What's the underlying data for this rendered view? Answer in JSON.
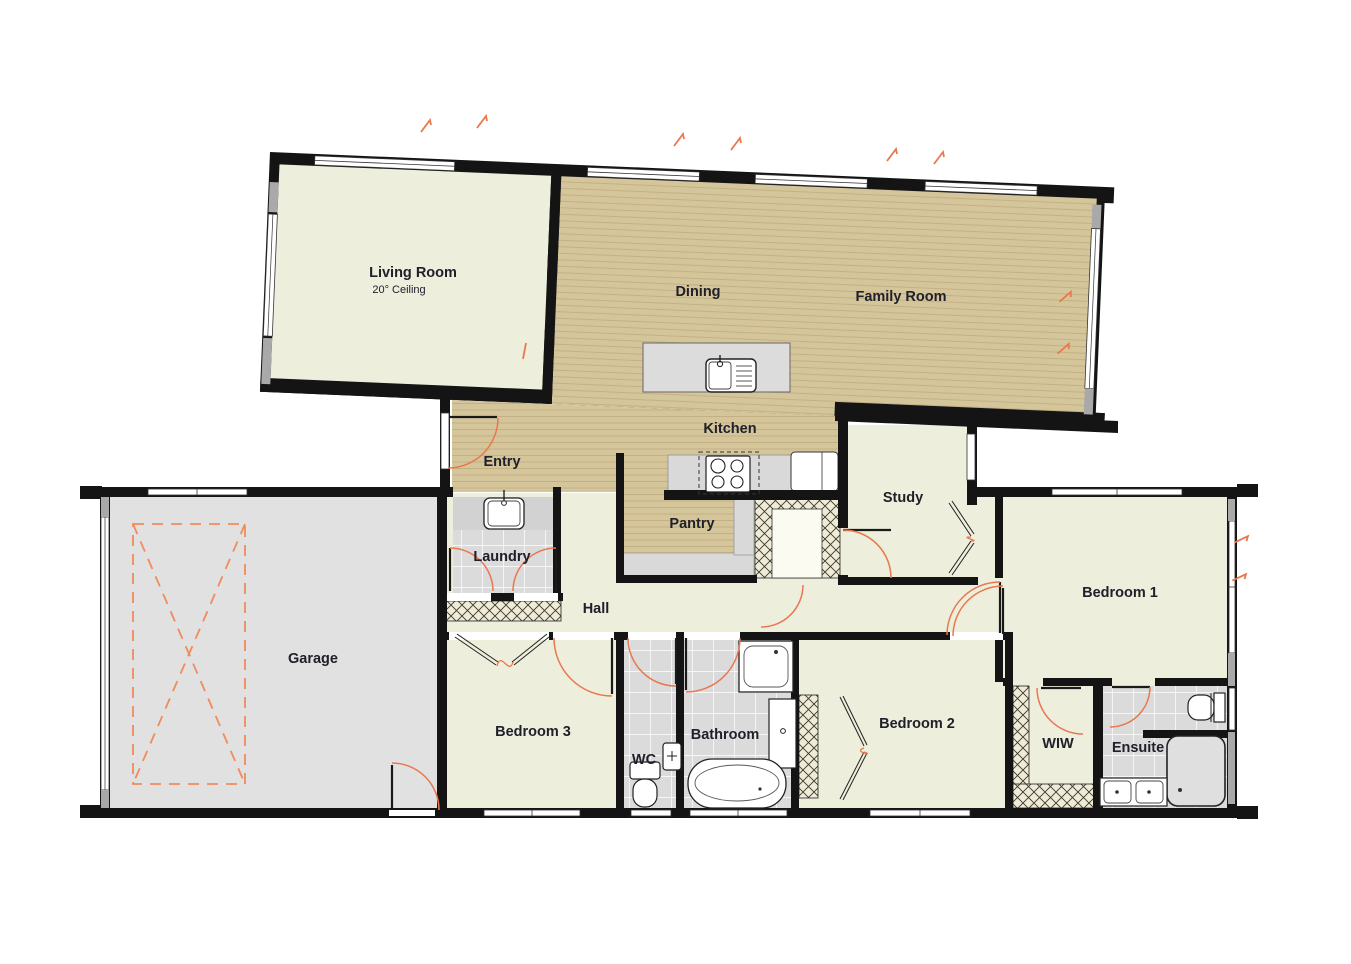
{
  "document": {
    "type": "residential-floor-plan",
    "view": "top-down single storey plan"
  },
  "colors": {
    "wall": "#141414",
    "floor_cream": "#EDEEDC",
    "floor_wood": "#D5C59B",
    "wood_stripe": "#C3B184",
    "floor_tile": "#DCDCDC",
    "floor_garage": "#E1E1E1",
    "hatch_bg": "#EFEBD8",
    "door_arc": "#E8784E",
    "dashed_marking": "#F08B5C"
  },
  "rooms": [
    {
      "id": "living-room",
      "label": "Living Room",
      "sublabel": "20° Ceiling"
    },
    {
      "id": "dining",
      "label": "Dining"
    },
    {
      "id": "family-room",
      "label": "Family Room"
    },
    {
      "id": "kitchen",
      "label": "Kitchen"
    },
    {
      "id": "entry",
      "label": "Entry"
    },
    {
      "id": "pantry",
      "label": "Pantry"
    },
    {
      "id": "study",
      "label": "Study"
    },
    {
      "id": "laundry",
      "label": "Laundry"
    },
    {
      "id": "hall",
      "label": "Hall"
    },
    {
      "id": "garage",
      "label": "Garage"
    },
    {
      "id": "bedroom-3",
      "label": "Bedroom 3"
    },
    {
      "id": "wc",
      "label": "WC"
    },
    {
      "id": "bathroom",
      "label": "Bathroom"
    },
    {
      "id": "bedroom-2",
      "label": "Bedroom 2"
    },
    {
      "id": "wiw",
      "label": "WIW"
    },
    {
      "id": "ensuite",
      "label": "Ensuite"
    },
    {
      "id": "bedroom-1",
      "label": "Bedroom 1"
    }
  ],
  "fixtures": [
    "kitchen-island-sink",
    "cooktop",
    "fridge",
    "laundry-tub",
    "bathtub",
    "shower",
    "vanity",
    "toilet",
    "ensuite-shower",
    "ensuite-double-vanity",
    "ensuite-toilet",
    "wc-toilet",
    "wc-basin"
  ]
}
